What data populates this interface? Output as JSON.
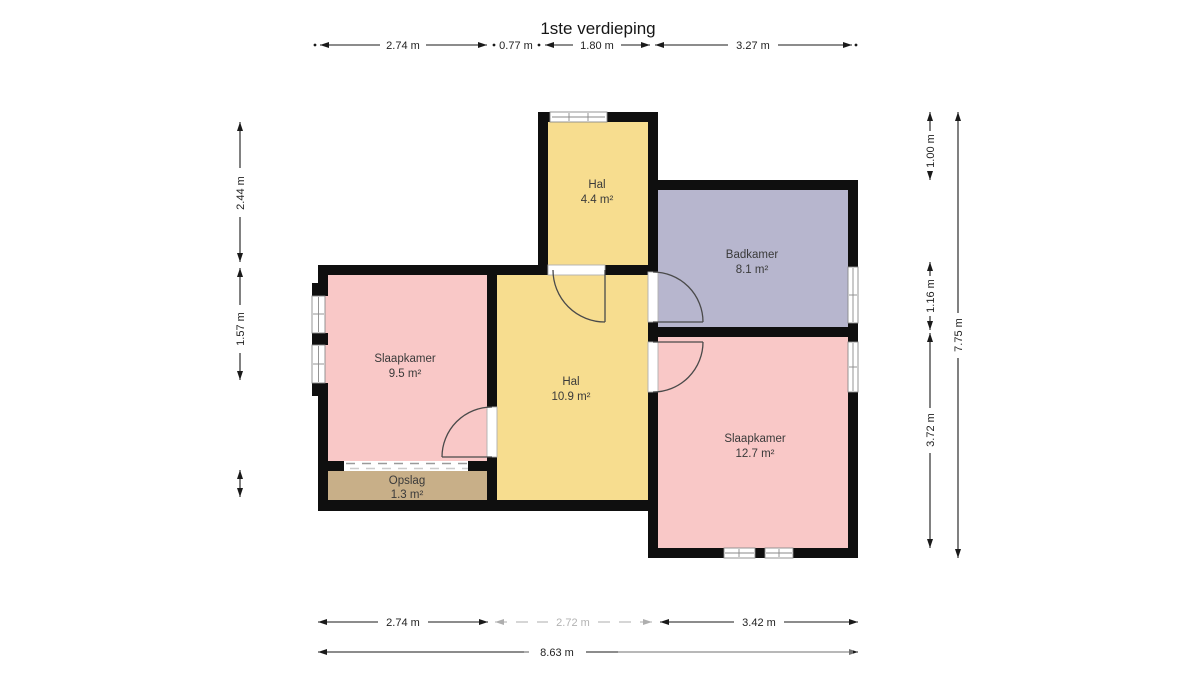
{
  "title": "1ste verdieping",
  "colors": {
    "hall": "#f7dd8f",
    "bedroom": "#f9c8c7",
    "bathroom": "#b7b6ce",
    "storage": "#c8af88",
    "wall": "#0f0f0f"
  },
  "rooms": {
    "hal_top": {
      "name": "Hal",
      "area": "4.4 m²"
    },
    "badkamer": {
      "name": "Badkamer",
      "area": "8.1 m²"
    },
    "slaapkamer_l": {
      "name": "Slaapkamer",
      "area": "9.5 m²"
    },
    "hal_main": {
      "name": "Hal",
      "area": "10.9 m²"
    },
    "slaapkamer_r": {
      "name": "Slaapkamer",
      "area": "12.7 m²"
    },
    "opslag": {
      "name": "Opslag",
      "area": "1.3 m²"
    }
  },
  "dimensions": {
    "top": [
      "2.74 m",
      "0.77 m",
      "1.80 m",
      "3.27 m"
    ],
    "left": [
      "2.44 m",
      "1.57 m"
    ],
    "right_inner": [
      "1.00 m",
      "1.16 m",
      "3.72 m"
    ],
    "right_total": "7.75 m",
    "bottom": [
      "2.74 m",
      "2.72 m",
      "3.42 m"
    ],
    "bottom_total": "8.63 m"
  }
}
